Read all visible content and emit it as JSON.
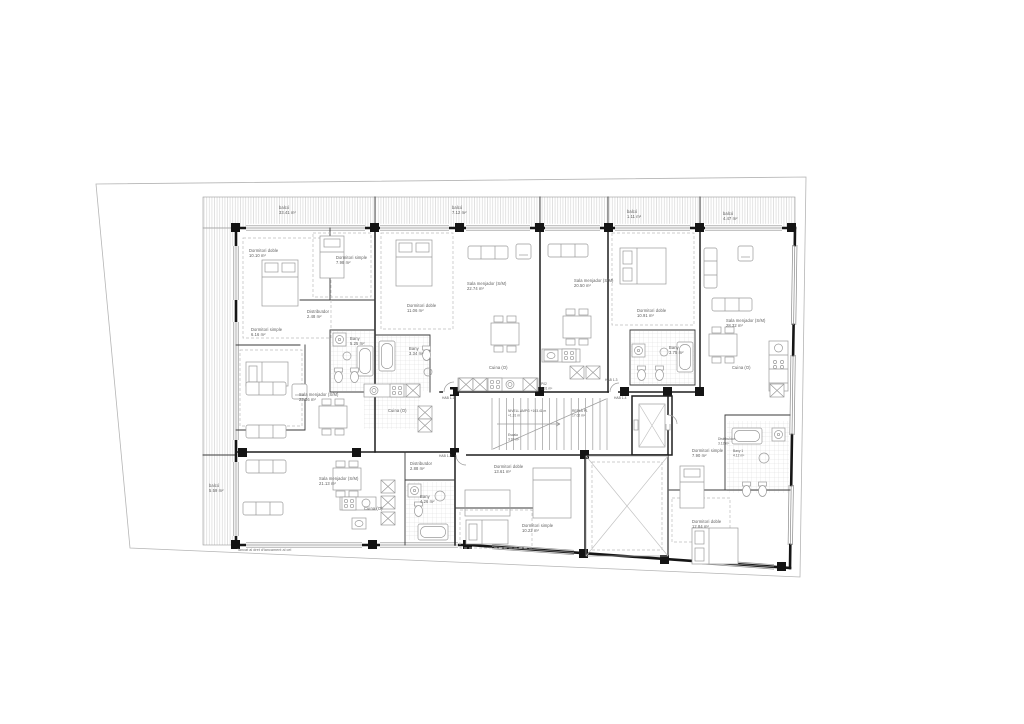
{
  "drawing": {
    "note_bottom": "Tancat al dret d'tancament al cel",
    "level": {
      "line1": "NIVELL AMPG +103.41 m",
      "line2": "+1.31 m"
    },
    "landing": {
      "name": "REPLÀ P1",
      "area": "17.02 m²"
    },
    "stair": {
      "name": "Escala",
      "area": "3.97 m²"
    },
    "door": {
      "name": "P02",
      "area": "1.31 m²"
    },
    "units": {
      "hab11": "HAB 1-1",
      "hab12": "HAB 1-2",
      "hab13": "HAB 1-3",
      "hab14": "HAB 1-4"
    },
    "rooms": {
      "balco1": {
        "name": "balcó",
        "area": "33.41 m²"
      },
      "balco2": {
        "name": "balcó",
        "area": "7.12 m²"
      },
      "balco3": {
        "name": "balcó",
        "area": "1.11 m²"
      },
      "balco4": {
        "name": "balcó",
        "area": "4.47 m²"
      },
      "balco5": {
        "name": "balcó",
        "area": "5.59 m²"
      },
      "dd1": {
        "name": "Dormitori doble",
        "area": "10.10 m²"
      },
      "ds1": {
        "name": "Dormitori simple",
        "area": "7.98 m²"
      },
      "dist1": {
        "name": "Distribuïdor",
        "area": "2.48 m²"
      },
      "ds2": {
        "name": "Dormitori simple",
        "area": "6.16 m²"
      },
      "bany1": {
        "name": "Bany",
        "area": "5.25 m²"
      },
      "dd2": {
        "name": "Dormitori doble",
        "area": "11.06 m²"
      },
      "bany2": {
        "name": "Bany",
        "area": "3.34 m²"
      },
      "sm1": {
        "name": "Sala menjador (S/M)",
        "area": "22.74 m²"
      },
      "cuina1": {
        "name": "Cuina (O)",
        "area": ""
      },
      "sm2": {
        "name": "Sala menjador (S/M)",
        "area": "20.50 m²"
      },
      "dd3": {
        "name": "Dormitori doble",
        "area": "10.91 m²"
      },
      "bany3": {
        "name": "Bany",
        "area": "3.75 m²"
      },
      "sm3": {
        "name": "Sala menjador (S/M)",
        "area": "28.32 m²"
      },
      "cuina2": {
        "name": "Cuina (O)",
        "area": ""
      },
      "sm4": {
        "name": "Sala menjador (S/M)",
        "area": "23.36 m²"
      },
      "cuina3": {
        "name": "Cuina (O)",
        "area": ""
      },
      "sm5": {
        "name": "Sala menjador (S/M)",
        "area": "21.13 m²"
      },
      "cuina4": {
        "name": "Cuina (O)",
        "area": ""
      },
      "dist2": {
        "name": "Distribuïdor",
        "area": "2.88 m²"
      },
      "bany4": {
        "name": "Bany",
        "area": "4.26 m²"
      },
      "dd4": {
        "name": "Dormitori doble",
        "area": "13.61 m²"
      },
      "ds3": {
        "name": "Dormitori simple",
        "area": "10.22 m²"
      },
      "ds4": {
        "name": "Dormitori simple",
        "area": "7.90 m²"
      },
      "dist3": {
        "name": "Distribuïdor",
        "area": "3.12 m²"
      },
      "bany5": {
        "name": "Bany 1",
        "area": "4.12 m²"
      },
      "dd5": {
        "name": "Dormitori doble",
        "area": "12.84 m²"
      }
    }
  }
}
